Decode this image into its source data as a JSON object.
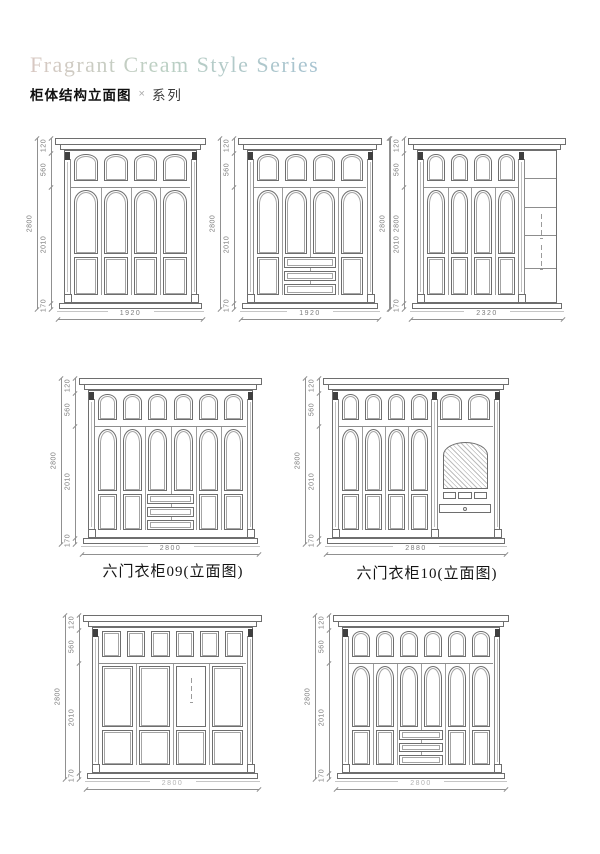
{
  "header": {
    "title": "Fragrant Cream Style Series",
    "subtitle_main": "柜体结构立面图",
    "subtitle_sep": "×",
    "subtitle_series": "系列"
  },
  "drawing_colors": {
    "line": "#6e6e6e",
    "inner_panel": "#a4a4a4",
    "dim_line": "#909090",
    "dim_text": "#7c7c7c",
    "capital_dark": "#3f3f3f"
  },
  "cabinets": [
    {
      "side_dims": [
        "120",
        "560",
        "2010",
        "170"
      ],
      "total_height": "2800",
      "width": "1920"
    },
    {
      "side_dims": [
        "120",
        "560",
        "2010",
        "170"
      ],
      "total_height": "2800",
      "right_height": "2800",
      "width": "1920"
    },
    {
      "side_dims": [
        "120",
        "560",
        "2010",
        "170"
      ],
      "total_height": "2800",
      "width": "2320"
    },
    {
      "side_dims": [
        "120",
        "560",
        "2010",
        "170"
      ],
      "total_height": "2800",
      "width": "2800",
      "caption": "六门衣柜09(立面图)"
    },
    {
      "side_dims": [
        "120",
        "560",
        "2010",
        "170"
      ],
      "total_height": "2800",
      "width": "2880",
      "caption": "六门衣柜10(立面图)"
    },
    {
      "side_dims": [
        "120",
        "560",
        "2010",
        "170"
      ],
      "total_height": "2800",
      "width": "2800"
    },
    {
      "side_dims": [
        "120",
        "560",
        "2010",
        "170"
      ],
      "total_height": "2800",
      "width": "2800"
    }
  ]
}
